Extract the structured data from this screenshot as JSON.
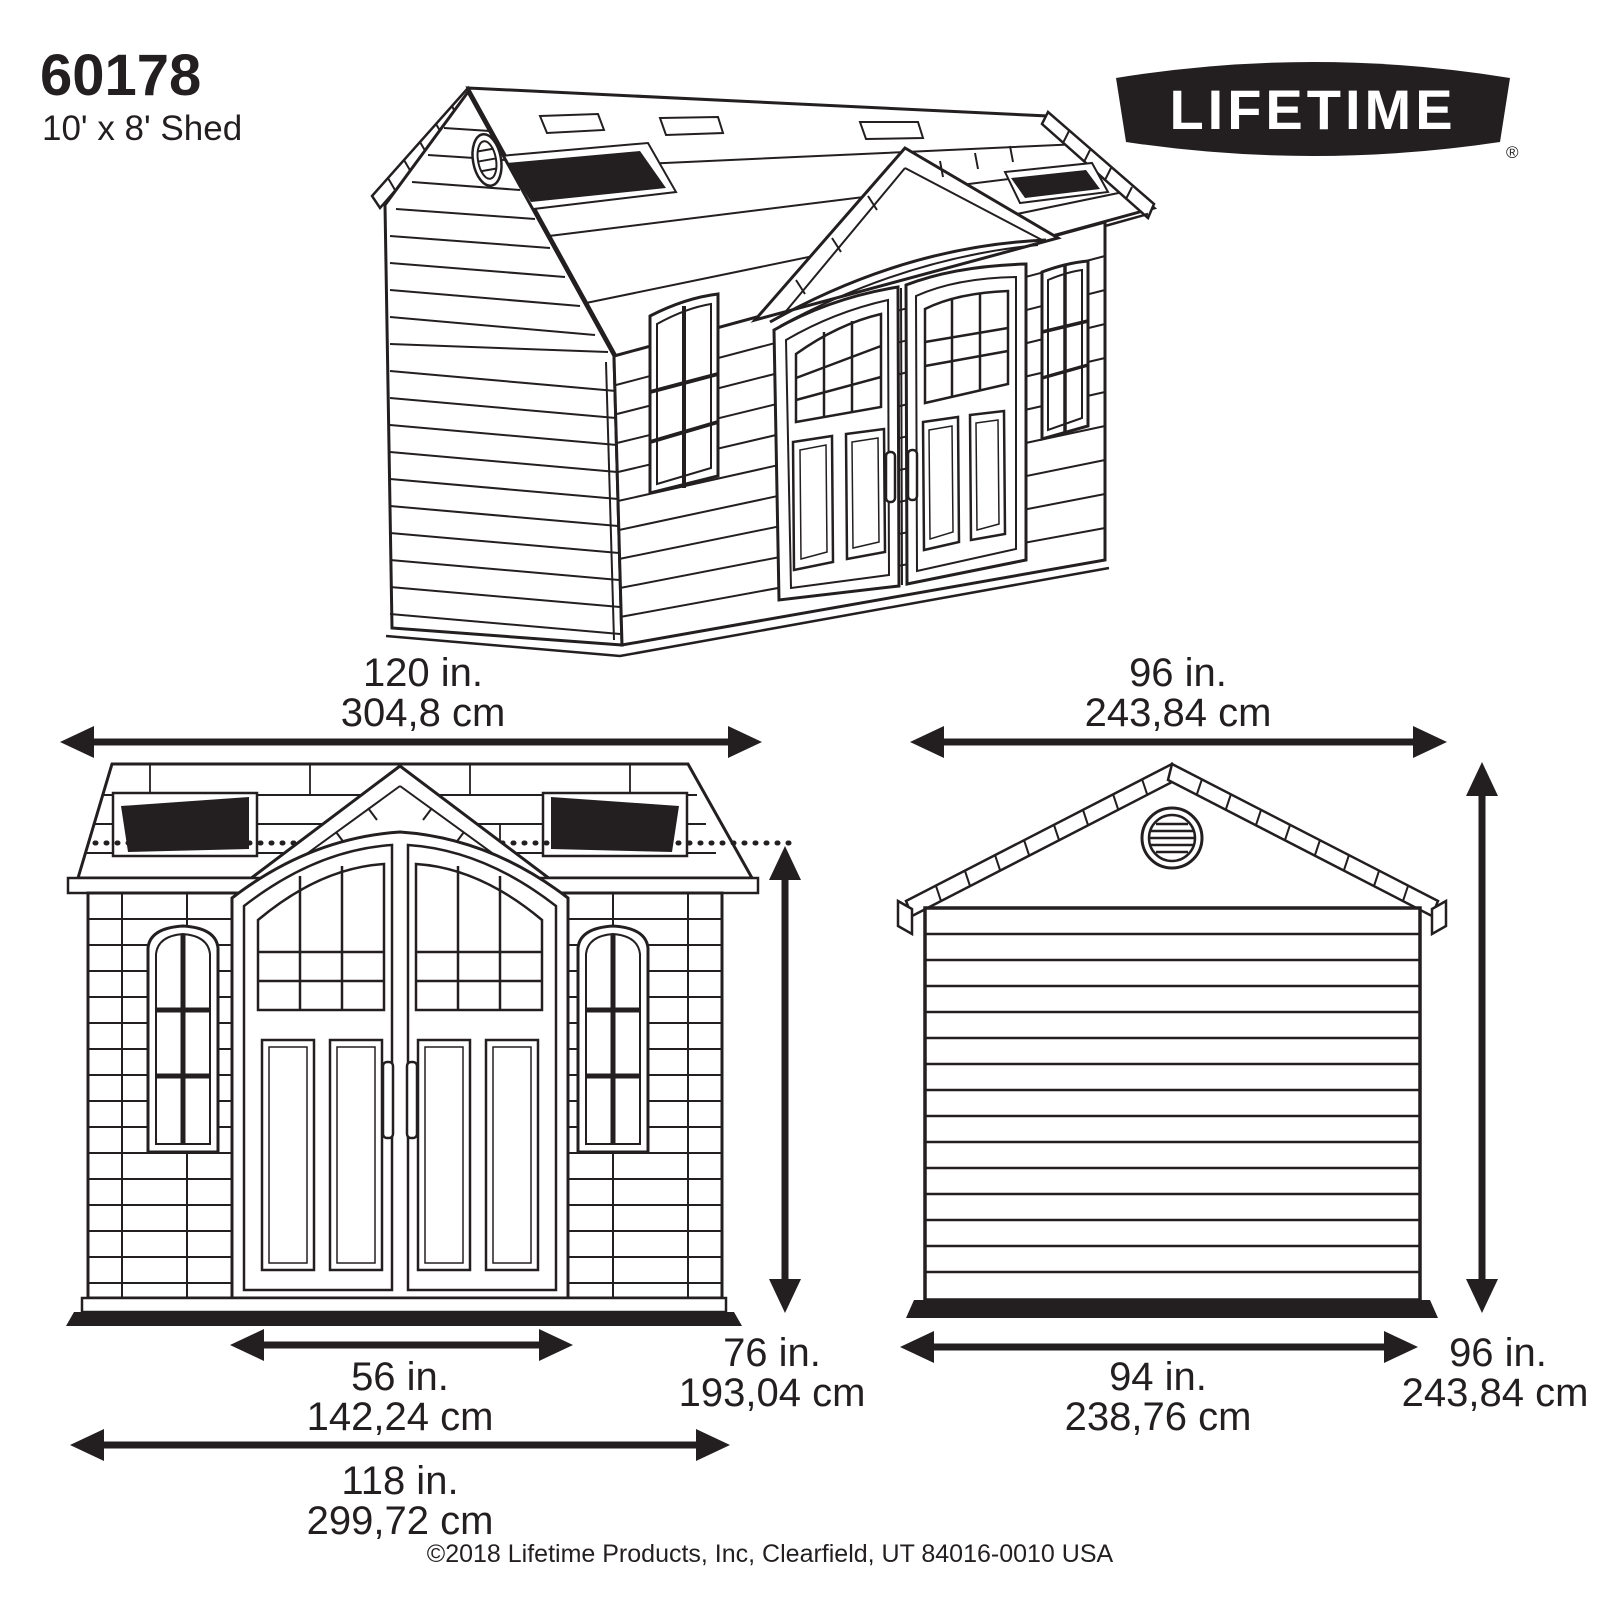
{
  "header": {
    "part_number": "60178",
    "product_size": "10' x 8' Shed"
  },
  "brand": {
    "logo_text": "LIFETIME",
    "registered_mark": "®"
  },
  "front_view": {
    "overall_width_in": "120 in.",
    "overall_width_cm": "304,8 cm",
    "door_width_in": "56 in.",
    "door_width_cm": "142,24 cm",
    "wall_height_in": "76 in.",
    "wall_height_cm": "193,04 cm",
    "base_width_in": "118 in.",
    "base_width_cm": "299,72 cm"
  },
  "side_view": {
    "overall_depth_in": "96 in.",
    "overall_depth_cm": "243,84 cm",
    "base_depth_in": "94 in.",
    "base_depth_cm": "238,76 cm",
    "overall_height_in": "96 in.",
    "overall_height_cm": "243,84 cm"
  },
  "footer": {
    "copyright": "©2018 Lifetime Products, Inc, Clearfield, UT 84016-0010 USA"
  },
  "ink_color": "#231f20"
}
